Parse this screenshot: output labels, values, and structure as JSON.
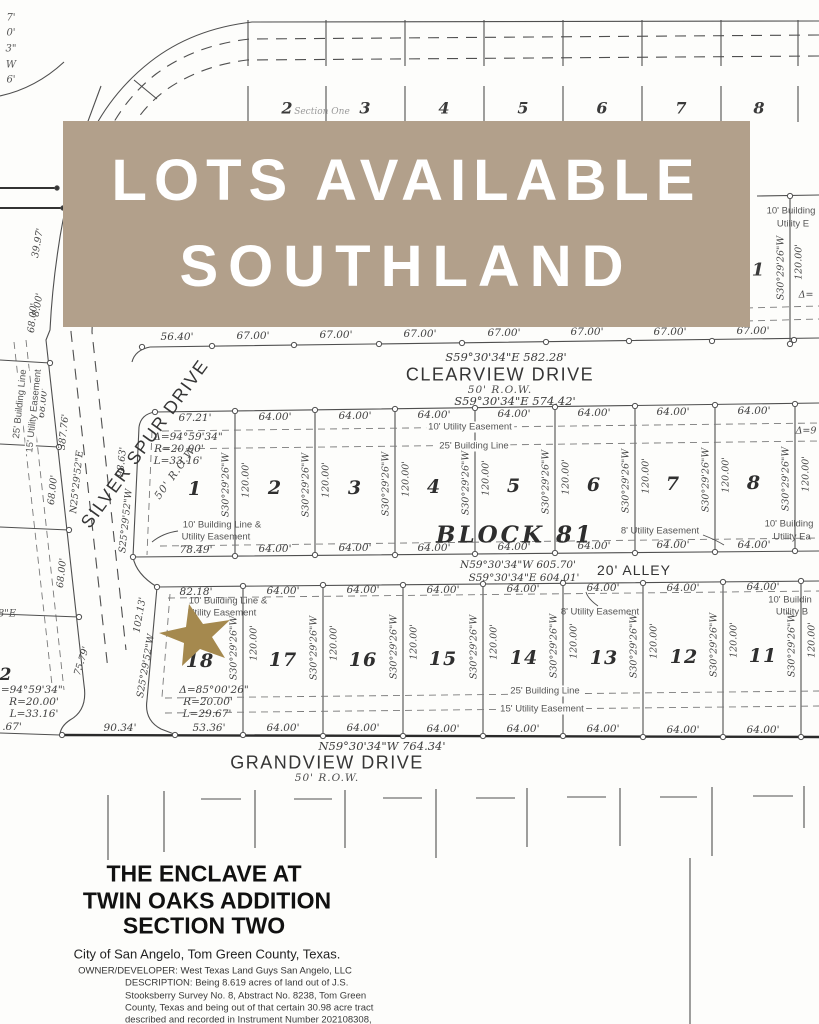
{
  "banner": {
    "title": "LOTS AVAILABLE",
    "subtitle": "SOUTHLAND",
    "bg_color": "#b2a08b",
    "text_color": "#ffffff"
  },
  "marker": {
    "star_color": "#a5894e"
  },
  "plat": {
    "common": {
      "side_bearing": "S30°29'26\"W",
      "side_distance": "120.00'"
    },
    "top_block": {
      "lots": [
        "2",
        "3",
        "4",
        "5",
        "6",
        "7",
        "8"
      ],
      "corner_lot": "1",
      "note": "Section One",
      "right_edge": {
        "line1": "10' Building",
        "line2": "Utility E",
        "delta_frag": "Δ="
      }
    },
    "clearview": {
      "name": "CLEARVIEW DRIVE",
      "row": "50' R.O.W.",
      "bearing": "S59°30'34\"E  582.28'",
      "measurements": [
        "56.40'",
        "67.00'",
        "67.00'",
        "67.00'",
        "67.00'",
        "67.00'",
        "67.00'",
        "67.00'"
      ]
    },
    "block81": {
      "label": "BLOCK 81",
      "lots": [
        "1",
        "2",
        "3",
        "4",
        "5",
        "6",
        "7",
        "8"
      ],
      "north_bearing": "S59°30'34\"E  574.42'",
      "north_measurements": [
        "67.21'",
        "64.00'",
        "64.00'",
        "64.00'",
        "64.00'",
        "64.00'",
        "64.00'",
        "64.00'"
      ],
      "south_measurements": [
        "78.49'",
        "64.00'",
        "64.00'",
        "64.00'",
        "64.00'",
        "64.00'",
        "64.00'",
        "64.00'"
      ],
      "curve": {
        "delta": "Δ=94°59'34\"",
        "radius": "R=20.00'",
        "length": "L=33.16'"
      },
      "west_distance": "98.63'",
      "west_bearing": "S25°29'52\"W",
      "easement_utility10": "10' Utility Easement",
      "easement_building25": "25' Building Line",
      "easement_bl_ue_1": "10' Building Line &",
      "easement_bl_ue_2": "Utility Easement",
      "easement_utility8": "8' Utility Easement",
      "right_edge": {
        "line1": "10' Building",
        "line2": "Utility Ea",
        "delta_frag": "Δ=9"
      }
    },
    "alley": {
      "label": "20' ALLEY",
      "north_bearing": "N59°30'34\"W  605.70'",
      "south_bearing": "S59°30'34\"E  604.01'"
    },
    "south_block": {
      "lots": [
        "18",
        "17",
        "16",
        "15",
        "14",
        "13",
        "12",
        "11"
      ],
      "north_measurements": [
        "82.18'",
        "64.00'",
        "64.00'",
        "64.00'",
        "64.00'",
        "64.00'",
        "64.00'",
        "64.00'"
      ],
      "south_measurements": [
        "53.36'",
        "64.00'",
        "64.00'",
        "64.00'",
        "64.00'",
        "64.00'",
        "64.00'",
        "64.00'"
      ],
      "curve": {
        "delta": "Δ=85°00'26\"",
        "radius": "R=20.00'",
        "length": "L=29.67'"
      },
      "west_distance": "102.13'",
      "west_bearing": "S25°29'52\"W",
      "west_frontage": "75.79'",
      "easement_bl_ue_1": "10' Building Line &",
      "easement_bl_ue_2": "Utility Easement",
      "easement_utility8": "8' Utility Easement",
      "easement_building25": "25' Building Line",
      "easement_utility15": "15' Utility Easement",
      "right_edge": {
        "line1": "10' Buildin",
        "line2": "Utility B"
      }
    },
    "grandview": {
      "name": "GRANDVIEW DRIVE",
      "row": "50' R.O.W.",
      "bearing": "N59°30'34\"W  764.34'",
      "west_measurements": [
        ".67'",
        "90.34'"
      ]
    },
    "silver_spur": {
      "name": "SILVER SPUR DRIVE",
      "row": "50' R.O.W.",
      "bearing": "N25°29'52\"E",
      "total": "387.76'",
      "segments": [
        "68.00'",
        "68.00'",
        "68.00'",
        "68.00'"
      ],
      "easement_utility15": "15' Utility Easement",
      "easement_building25": "25' Building Line"
    },
    "curve_street": {
      "arc1": "39.97'",
      "arc2": "8.00'",
      "edge_fragments": [
        "7'",
        "0'",
        "3\"",
        "W",
        "6'"
      ]
    },
    "left_block": {
      "lot": "2",
      "curve": {
        "delta": "Δ=94°59'34\"",
        "radius": "R=20.00'",
        "length": "L=33.16'"
      },
      "bearing_fragment": "8\"E"
    }
  },
  "title_block": {
    "title_line1": "THE ENCLAVE AT",
    "title_line2": "TWIN OAKS ADDITION",
    "title_line3": "SECTION TWO",
    "city": "City of San Angelo, Tom Green County, Texas.",
    "owner": "OWNER/DEVELOPER: West Texas Land Guys San Angelo, LLC",
    "description": [
      "DESCRIPTION:  Being 8.619 acres of land out of J.S.",
      "Stooksberry Survey No. 8, Abstract No. 8238, Tom Green",
      "County, Texas and being out of that certain 30.98 acre tract",
      "described and recorded in Instrument Number 202108308,",
      "Official Public Records of Tom Green County, Texas"
    ]
  }
}
